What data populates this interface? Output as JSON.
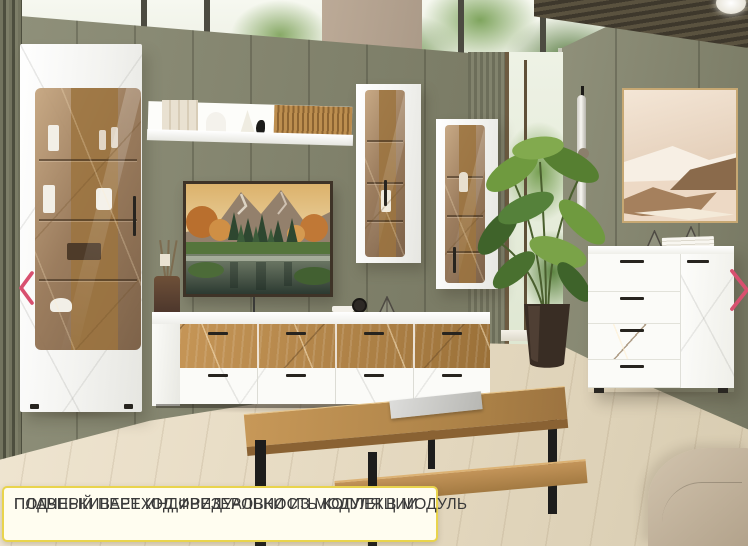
{
  "caption": {
    "line1": "ПЛАВНЫЙ ПЕРЕХОД ФРЕЗЕРОВКИ ИЗ МОДУЛЯ В МОДУЛЬ",
    "line2": "ПОДЧЕРКИВАЕТ ИНДИВИДУАЛЬНОСТЬ КОЛЛЕКЦИИ"
  },
  "carousel": {
    "prev_icon": "chevron-left",
    "next_icon": "chevron-right"
  },
  "colors": {
    "caption_border": "#e9d44c",
    "caption_background": "#fffdf0",
    "caption_text": "#3a3a3a",
    "arrow_pink": "#d8506f",
    "wall_olive": "#83846e",
    "wood_oak": "#bd8f52",
    "furniture_white": "#fbfbf8"
  }
}
